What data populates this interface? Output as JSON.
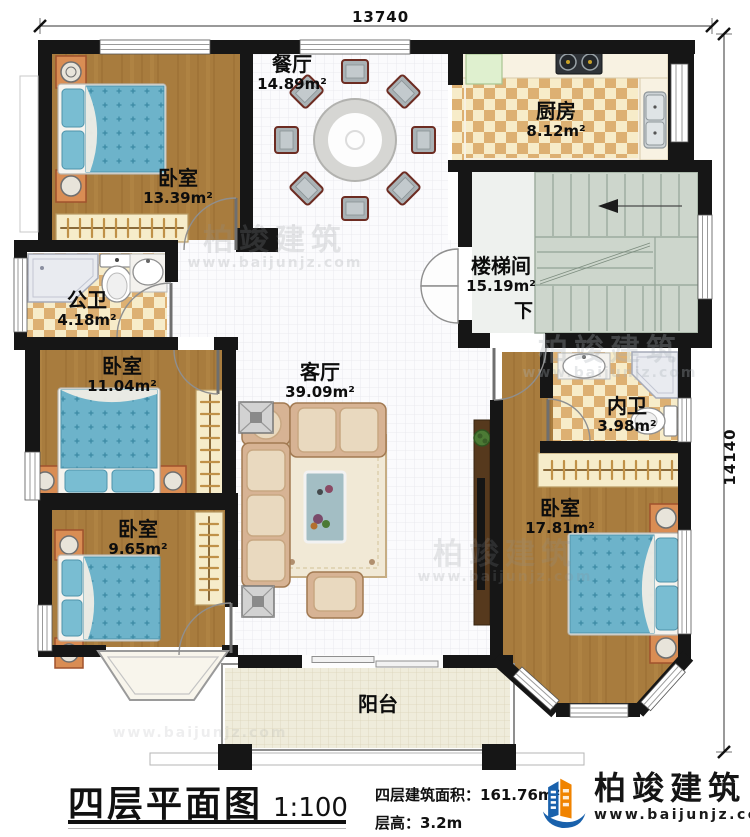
{
  "dimensions": {
    "width_label": "13740",
    "height_label": "14140"
  },
  "rooms": {
    "bedroom_top_left": {
      "name": "卧室",
      "area": "13.39m²"
    },
    "dining": {
      "name": "餐厅",
      "area": "14.89m²"
    },
    "kitchen": {
      "name": "厨房",
      "area": "8.12m²"
    },
    "stairwell": {
      "name": "楼梯间",
      "area": "15.19m²",
      "down": "下"
    },
    "public_bath": {
      "name": "公卫",
      "area": "4.18m²"
    },
    "bedroom_mid_left": {
      "name": "卧室",
      "area": "11.04m²"
    },
    "living": {
      "name": "客厅",
      "area": "39.09m²"
    },
    "private_bath": {
      "name": "内卫",
      "area": "3.98m²"
    },
    "bedroom_bottom_left": {
      "name": "卧室",
      "area": "9.65m²"
    },
    "bedroom_bottom_right": {
      "name": "卧室",
      "area": "17.81m²"
    },
    "balcony": {
      "name": "阳台"
    }
  },
  "title_block": {
    "title": "四层平面图",
    "scale": "1:100",
    "area_text": "四层建筑面积：161.76m²",
    "floor_height_text": "层高：3.2m"
  },
  "branding": {
    "company": "柏竣建筑",
    "website": "www.baijunjz.com"
  },
  "colors": {
    "wall": "#161616",
    "wood_floor": "#a87c3e",
    "bed_blue": "#6db3ca",
    "tile_checker": "#ddb072",
    "stairs": "#cdd6cc",
    "logo_blue": "#1961ac",
    "logo_orange": "#f08300"
  }
}
